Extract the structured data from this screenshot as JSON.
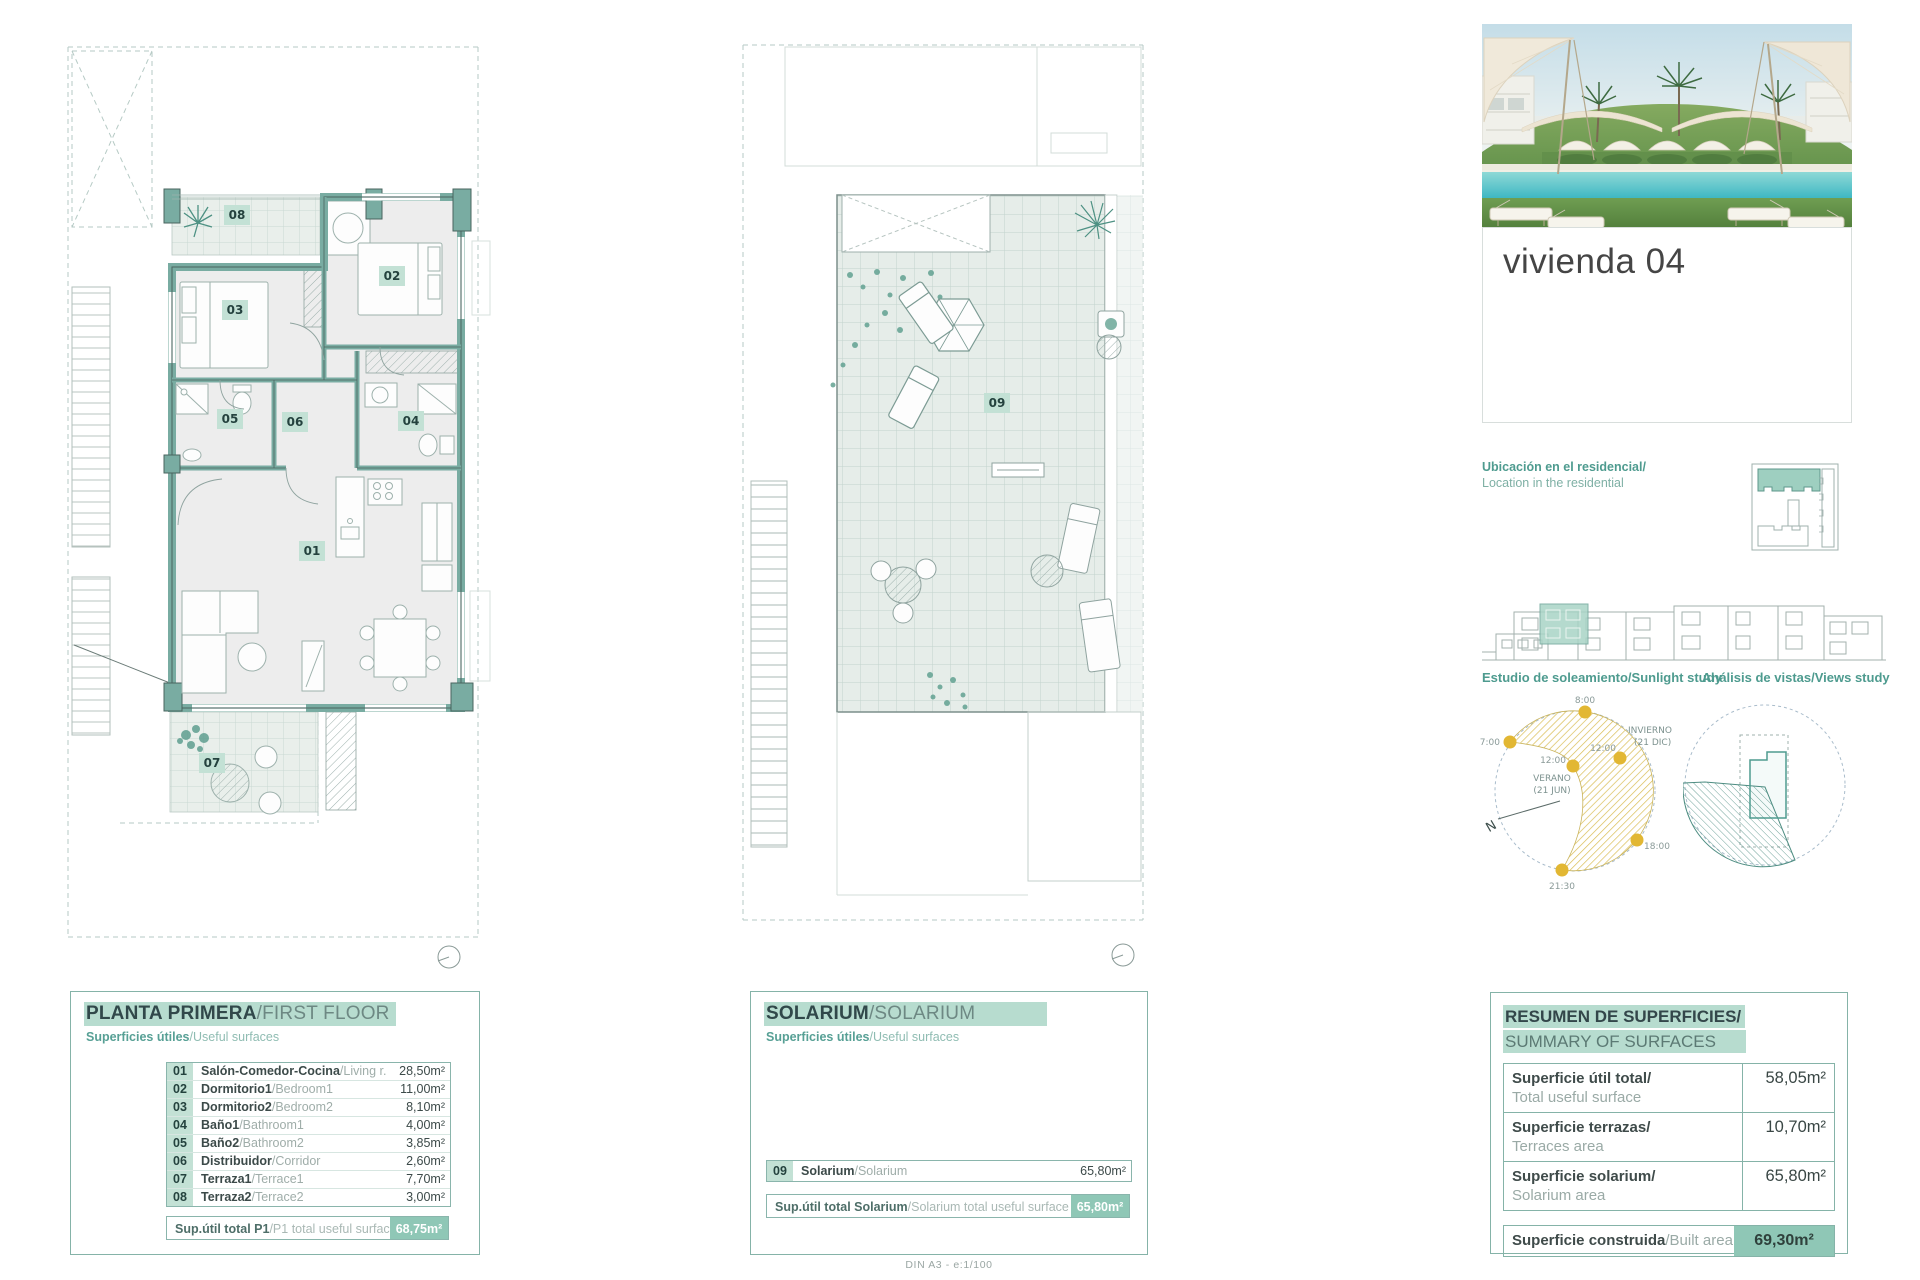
{
  "doc": {
    "scale_note": "DIN A3 - e:1/100"
  },
  "unit": {
    "title": "vivienda 04"
  },
  "plan_badges": [
    "01",
    "02",
    "03",
    "04",
    "05",
    "06",
    "07",
    "08",
    "09"
  ],
  "first_floor": {
    "title_es": "PLANTA PRIMERA",
    "title_en": "/FIRST FLOOR",
    "sub_es": "Superficies útiles",
    "sub_en": "/Useful surfaces",
    "rows": [
      {
        "num": "01",
        "es": "Salón-Comedor-Cocina",
        "en": "/Living r.-Kitchen",
        "area": "28,50m²"
      },
      {
        "num": "02",
        "es": "Dormitorio1",
        "en": "/Bedroom1",
        "area": "11,00m²"
      },
      {
        "num": "03",
        "es": "Dormitorio2",
        "en": "/Bedroom2",
        "area": "8,10m²"
      },
      {
        "num": "04",
        "es": "Baño1",
        "en": "/Bathroom1",
        "area": "4,00m²"
      },
      {
        "num": "05",
        "es": "Baño2",
        "en": "/Bathroom2",
        "area": "3,85m²"
      },
      {
        "num": "06",
        "es": "Distribuidor",
        "en": "/Corridor",
        "area": "2,60m²"
      },
      {
        "num": "07",
        "es": "Terraza1",
        "en": "/Terrace1",
        "area": "7,70m²"
      },
      {
        "num": "08",
        "es": "Terraza2",
        "en": "/Terrace2",
        "area": "3,00m²"
      }
    ],
    "total_es": "Sup.útil total P1",
    "total_en": "/P1 total useful surface",
    "total_area": "68,75m²"
  },
  "solarium": {
    "title_es": "SOLARIUM",
    "title_en": "/SOLARIUM",
    "sub_es": "Superficies útiles",
    "sub_en": "/Useful surfaces",
    "rows": [
      {
        "num": "09",
        "es": "Solarium",
        "en": "/Solarium",
        "area": "65,80m²"
      }
    ],
    "total_es": "Sup.útil total Solarium",
    "total_en": "/Solarium total useful surface",
    "total_area": "65,80m²"
  },
  "location": {
    "label_es": "Ubicación en el residencial/",
    "label_en": "Location in the residential"
  },
  "studies": {
    "sunlight": "Estudio de soleamiento/Sunlight study",
    "views": "Análisis de vistas/Views study"
  },
  "sun": {
    "t0800": "8:00",
    "t0700": "7:00",
    "t1200_summer": "12:00",
    "season_summer": "VERANO",
    "date_summer": "(21 JUN)",
    "t1200_winter": "12:00",
    "season_winter": "INVIERNO",
    "date_winter": "(21 DIC)",
    "t1800": "18:00",
    "t2130": "21:30",
    "north": "N"
  },
  "summary": {
    "title_es": "RESUMEN DE SUPERFICIES/",
    "title_en": "SUMMARY OF SURFACES",
    "rows": [
      {
        "es": "Superficie útil total/",
        "en": "Total useful surface",
        "area": "58,05m²"
      },
      {
        "es": "Superficie terrazas/",
        "en": "Terraces area",
        "area": "10,70m²"
      },
      {
        "es": "Superficie solarium/",
        "en": "Solarium area",
        "area": "65,80m²"
      }
    ],
    "built_es": "Superficie construida",
    "built_en": "/Built area",
    "built_area": "69,30m²"
  },
  "colors": {
    "accent": "#4e9b8f",
    "highlight": "#b7dccf",
    "wall": "#79aca2",
    "total_bg": "#8fc7b6",
    "sun_yellow": "#e2b733"
  }
}
